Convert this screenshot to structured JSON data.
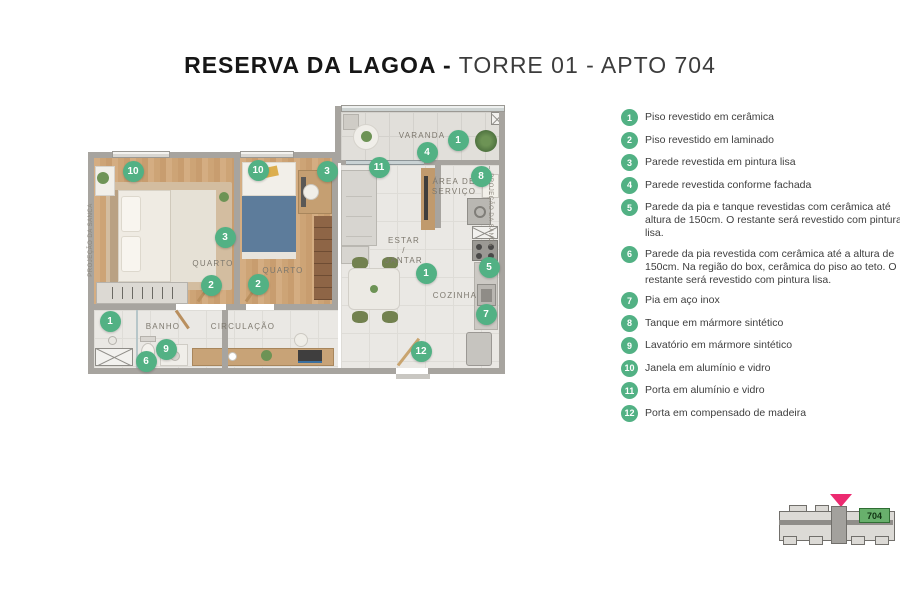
{
  "title": {
    "bold": "RESERVA DA LAGOA -",
    "light": "TORRE 01 - APTO 704"
  },
  "colors": {
    "marker_green": "#52b184",
    "pointer_pink": "#ec2a70",
    "unit_green": "#68b06c",
    "wall_grey": "#a7a49f"
  },
  "plan": {
    "rooms": [
      {
        "label": "VARANDA",
        "x": 422,
        "y": 136
      },
      {
        "label": "ÁREA DE\nSERVIÇO",
        "x": 454,
        "y": 187
      },
      {
        "label": "ESTAR / JANTAR",
        "x": 404,
        "y": 251
      },
      {
        "label": "COZINHA",
        "x": 455,
        "y": 296
      },
      {
        "label": "QUARTO",
        "x": 213,
        "y": 264
      },
      {
        "label": "QUARTO",
        "x": 283,
        "y": 271
      },
      {
        "label": "BANHO",
        "x": 163,
        "y": 327
      },
      {
        "label": "CIRCULAÇÃO",
        "x": 243,
        "y": 327
      }
    ],
    "wall_texts": [
      {
        "label": "PROJEÇÃO DA SANCA",
        "x": 91,
        "y": 240,
        "angle": -90
      },
      {
        "label": "PROJEÇÃO DA SANCA",
        "x": 490,
        "y": 210,
        "angle": 90
      }
    ],
    "markers": [
      {
        "num": "10",
        "x": 133,
        "y": 171
      },
      {
        "num": "10",
        "x": 258,
        "y": 170
      },
      {
        "num": "3",
        "x": 327,
        "y": 171
      },
      {
        "num": "11",
        "x": 379,
        "y": 167
      },
      {
        "num": "4",
        "x": 427,
        "y": 152
      },
      {
        "num": "1",
        "x": 458,
        "y": 140
      },
      {
        "num": "8",
        "x": 481,
        "y": 176
      },
      {
        "num": "3",
        "x": 225,
        "y": 237
      },
      {
        "num": "2",
        "x": 211,
        "y": 285
      },
      {
        "num": "2",
        "x": 258,
        "y": 284
      },
      {
        "num": "1",
        "x": 426,
        "y": 273
      },
      {
        "num": "5",
        "x": 489,
        "y": 267
      },
      {
        "num": "7",
        "x": 486,
        "y": 314
      },
      {
        "num": "12",
        "x": 421,
        "y": 351
      },
      {
        "num": "1",
        "x": 110,
        "y": 321
      },
      {
        "num": "6",
        "x": 146,
        "y": 361
      },
      {
        "num": "9",
        "x": 166,
        "y": 349
      }
    ]
  },
  "legend": {
    "items": [
      {
        "num": "1",
        "text": "Piso revestido em cerâmica"
      },
      {
        "num": "2",
        "text": "Piso revestido em laminado"
      },
      {
        "num": "3",
        "text": "Parede revestida em pintura lisa"
      },
      {
        "num": "4",
        "text": "Parede revestida conforme fachada"
      },
      {
        "num": "5",
        "text": "Parede da pia e tanque revestidas com cerâmica até altura de 150cm. O restante será revestido com pintura lisa."
      },
      {
        "num": "6",
        "text": "Parede da pia revestida com cerâmica até a altura de 150cm. Na região do box, cerâmica do piso ao teto. O restante será revestido com pintura lisa."
      },
      {
        "num": "7",
        "text": "Pia em aço inox"
      },
      {
        "num": "8",
        "text": "Tanque em mármore sintético"
      },
      {
        "num": "9",
        "text": "Lavatório em mármore sintético"
      },
      {
        "num": "10",
        "text": "Janela em alumínio e vidro"
      },
      {
        "num": "11",
        "text": "Porta em alumínio e vidro"
      },
      {
        "num": "12",
        "text": "Porta em compensado de madeira"
      }
    ]
  },
  "minimap": {
    "unit_label": "704"
  }
}
